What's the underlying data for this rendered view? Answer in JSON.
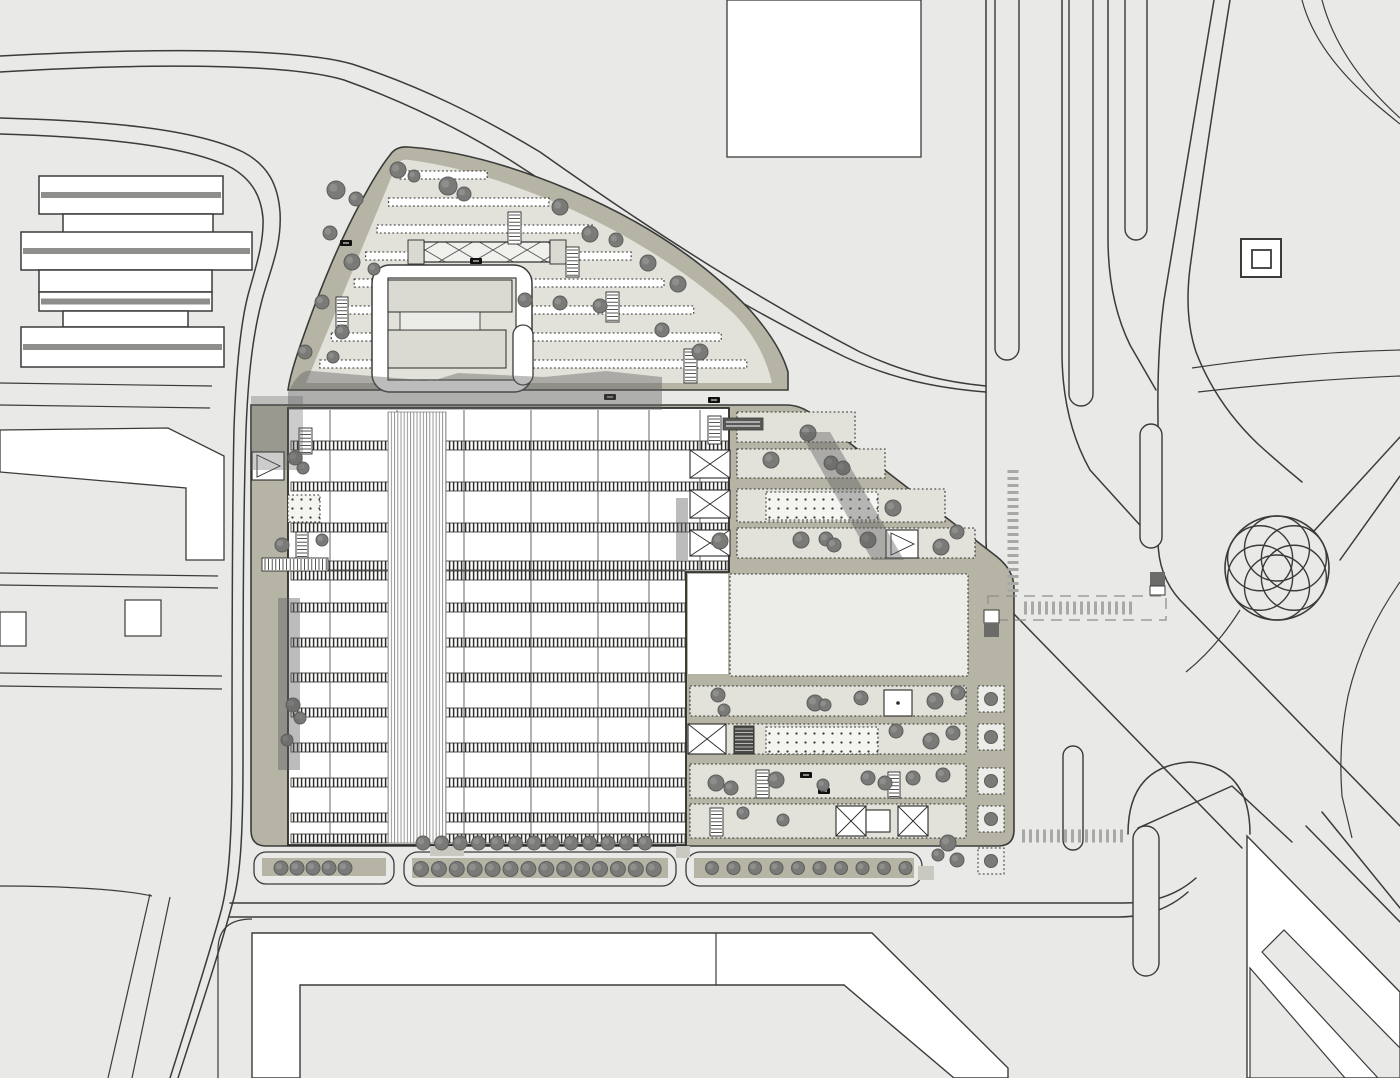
{
  "meta": {
    "title": "Architectural master plan site drawing",
    "drawing_type": "site-plan",
    "description": "Top-view urban master plan with central station building, landscaped fan-shaped site, boulevards, roundabout flower motif and surrounding city blocks"
  },
  "colors": {
    "background": "#e9e9e7",
    "line": "#3b3b39",
    "road_white": "#ffffff",
    "site_band_olive": "#b5b4a5",
    "site_strip_light": "#e2e1da",
    "plaza_lighter": "#ecece9",
    "shadow_gray": "#606060",
    "tree_gray": "#7a7a78",
    "tree_stroke": "#5d5d5b",
    "hatch_dark": "#2b2b29",
    "planter_beige": "#d5d3c4",
    "slab_gray": "#dad9d2",
    "dark_box": "#595957",
    "crosswalk_tick": "#a8a8a6"
  },
  "plan": {
    "left_bars": [
      [
        39,
        176,
        184,
        38,
        1
      ],
      [
        63,
        214,
        150,
        19,
        0
      ],
      [
        21,
        232,
        231,
        38,
        1
      ],
      [
        39,
        270,
        173,
        22,
        0
      ],
      [
        39,
        292,
        173,
        19,
        1
      ],
      [
        63,
        311,
        125,
        16,
        0
      ],
      [
        21,
        327,
        203,
        40,
        1
      ]
    ],
    "white_squares": [
      [
        125,
        600,
        36,
        36
      ],
      [
        0,
        612,
        26,
        34
      ]
    ],
    "north_white_block": [
      727,
      0,
      194,
      157
    ],
    "corner_double_square": {
      "outer": [
        1241,
        239,
        40,
        38
      ],
      "inner": [
        1252,
        250,
        19,
        18
      ]
    },
    "station": {
      "outline": [
        288,
        408,
        441,
        437
      ],
      "column_lines": [
        [
          330,
          410,
          843
        ],
        [
          397,
          410,
          843
        ],
        [
          464,
          410,
          843
        ],
        [
          531,
          410,
          843
        ],
        [
          598,
          410,
          843
        ],
        [
          649,
          410,
          843
        ],
        [
          700,
          410,
          570
        ]
      ],
      "track_bands": [
        [
          441,
          291,
          437
        ],
        [
          482,
          291,
          437
        ],
        [
          523,
          291,
          437
        ],
        [
          561,
          291,
          437
        ],
        [
          571,
          291,
          394
        ],
        [
          603,
          291,
          394
        ],
        [
          638,
          291,
          394
        ],
        [
          673,
          291,
          394
        ],
        [
          708,
          291,
          394
        ],
        [
          743,
          291,
          394
        ],
        [
          778,
          291,
          394
        ],
        [
          813,
          291,
          394
        ],
        [
          834,
          291,
          394
        ]
      ],
      "track_band_h": 9,
      "stripe_band": [
        388,
        412,
        58,
        431
      ]
    },
    "upper_strip_ys": [
      171,
      198,
      225,
      252,
      279,
      306,
      333,
      360
    ],
    "bands": [
      [
        737,
        412,
        118,
        30
      ],
      [
        737,
        449,
        148,
        29
      ],
      [
        737,
        489,
        208,
        33
      ],
      [
        737,
        528,
        238,
        30
      ],
      [
        690,
        686,
        276,
        30
      ],
      [
        690,
        724,
        276,
        30
      ],
      [
        690,
        764,
        276,
        34
      ],
      [
        690,
        804,
        276,
        34
      ]
    ],
    "dot_plazas": [
      [
        766,
        492,
        112,
        28
      ],
      [
        766,
        727,
        112,
        27
      ],
      [
        288,
        495,
        32,
        27
      ]
    ],
    "ladders": [
      [
        508,
        212,
        13,
        32,
        0,
        "v"
      ],
      [
        566,
        247,
        13,
        30,
        0,
        "v"
      ],
      [
        606,
        292,
        13,
        30,
        0,
        "v"
      ],
      [
        684,
        349,
        13,
        34,
        0,
        "v"
      ],
      [
        336,
        297,
        12,
        32,
        0,
        "v"
      ],
      [
        299,
        428,
        13,
        26,
        0,
        "v"
      ],
      [
        296,
        532,
        12,
        28,
        0,
        "v"
      ],
      [
        708,
        416,
        13,
        28,
        0,
        "v"
      ],
      [
        756,
        770,
        13,
        28,
        0,
        "v"
      ],
      [
        888,
        772,
        12,
        26,
        0,
        "v"
      ],
      [
        710,
        808,
        13,
        28,
        0,
        "v"
      ],
      [
        734,
        726,
        20,
        28,
        1,
        "v"
      ],
      [
        262,
        558,
        66,
        13,
        0,
        "h"
      ]
    ],
    "boxes": [
      [
        690,
        450,
        40,
        28,
        "x"
      ],
      [
        690,
        490,
        40,
        28,
        "x"
      ],
      [
        690,
        530,
        40,
        26,
        "x"
      ],
      [
        688,
        724,
        38,
        30,
        "x"
      ],
      [
        836,
        806,
        30,
        30,
        "x"
      ],
      [
        898,
        806,
        30,
        30,
        "x"
      ],
      [
        886,
        530,
        32,
        28,
        "tri"
      ],
      [
        252,
        452,
        32,
        28,
        "tri"
      ],
      [
        884,
        690,
        28,
        26,
        "sqdot"
      ],
      [
        866,
        810,
        24,
        22,
        "sq"
      ]
    ],
    "planter_squares": {
      "x": 978,
      "size": 26,
      "ys": [
        686,
        724,
        768,
        806,
        848
      ]
    },
    "beige_planters": {
      "y": 860,
      "size": 15,
      "xs": [
        700,
        722,
        744,
        766,
        788,
        810
      ]
    },
    "cars": [
      [
        340,
        240
      ],
      [
        470,
        258
      ],
      [
        604,
        394
      ],
      [
        708,
        397
      ],
      [
        728,
        856
      ],
      [
        772,
        856
      ],
      [
        818,
        856
      ],
      [
        800,
        772
      ],
      [
        818,
        788
      ]
    ],
    "trees": [
      [
        336,
        190,
        9
      ],
      [
        356,
        199,
        7
      ],
      [
        448,
        186,
        9
      ],
      [
        464,
        194,
        7
      ],
      [
        398,
        170,
        8
      ],
      [
        414,
        176,
        6
      ],
      [
        560,
        207,
        8
      ],
      [
        590,
        234,
        8
      ],
      [
        616,
        240,
        7
      ],
      [
        648,
        263,
        8
      ],
      [
        678,
        284,
        8
      ],
      [
        330,
        233,
        7
      ],
      [
        352,
        262,
        8
      ],
      [
        374,
        269,
        6
      ],
      [
        322,
        302,
        7
      ],
      [
        342,
        332,
        7
      ],
      [
        305,
        352,
        7
      ],
      [
        333,
        357,
        6
      ],
      [
        525,
        300,
        7
      ],
      [
        560,
        303,
        7
      ],
      [
        600,
        306,
        7
      ],
      [
        662,
        330,
        7
      ],
      [
        700,
        352,
        8
      ],
      [
        808,
        433,
        8
      ],
      [
        771,
        460,
        8
      ],
      [
        831,
        463,
        7
      ],
      [
        843,
        468,
        7
      ],
      [
        893,
        508,
        8
      ],
      [
        720,
        541,
        8
      ],
      [
        801,
        540,
        8
      ],
      [
        826,
        539,
        7
      ],
      [
        834,
        545,
        7
      ],
      [
        868,
        540,
        8
      ],
      [
        941,
        547,
        8
      ],
      [
        718,
        695,
        7
      ],
      [
        724,
        710,
        6
      ],
      [
        815,
        703,
        8
      ],
      [
        825,
        705,
        6
      ],
      [
        861,
        698,
        7
      ],
      [
        935,
        701,
        8
      ],
      [
        958,
        693,
        7
      ],
      [
        896,
        731,
        7
      ],
      [
        931,
        741,
        8
      ],
      [
        953,
        733,
        7
      ],
      [
        716,
        783,
        8
      ],
      [
        731,
        788,
        7
      ],
      [
        776,
        780,
        8
      ],
      [
        823,
        785,
        6
      ],
      [
        868,
        778,
        7
      ],
      [
        885,
        783,
        7
      ],
      [
        913,
        778,
        7
      ],
      [
        943,
        775,
        7
      ],
      [
        783,
        820,
        6
      ],
      [
        743,
        813,
        6
      ],
      [
        948,
        843,
        8
      ],
      [
        957,
        860,
        7
      ],
      [
        938,
        855,
        6
      ],
      [
        295,
        458,
        7
      ],
      [
        303,
        468,
        6
      ],
      [
        282,
        545,
        7
      ],
      [
        322,
        540,
        6
      ],
      [
        293,
        705,
        7
      ],
      [
        300,
        718,
        6
      ],
      [
        287,
        740,
        6
      ],
      [
        957,
        532,
        7
      ]
    ],
    "tree_rows": [
      {
        "x0": 423,
        "y": 843,
        "n": 13,
        "dx": 18.5,
        "r": 7
      },
      {
        "x0": 281,
        "y": 868,
        "n": 5,
        "dx": 16,
        "r": 7
      },
      {
        "x0": 421,
        "y": 869,
        "n": 14,
        "dx": 17.9,
        "r": 7.5
      },
      {
        "x0": 712,
        "y": 868,
        "n": 10,
        "dx": 21.5,
        "r": 6.5
      }
    ],
    "median_islands": [
      [
        995,
        -28,
        24,
        388
      ],
      [
        1069,
        -28,
        24,
        434
      ],
      [
        1125,
        -28,
        22,
        268
      ],
      [
        1140,
        424,
        22,
        124
      ],
      [
        1063,
        746,
        20,
        104
      ],
      [
        1133,
        826,
        26,
        150
      ]
    ],
    "crosswalk_ticks": [
      {
        "x": 1013,
        "y": 470,
        "len": 122,
        "o": "v"
      },
      {
        "x": 1024,
        "y": 608,
        "len": 112,
        "o": "h"
      },
      {
        "x": 1022,
        "y": 836,
        "len": 104,
        "o": "h"
      }
    ]
  }
}
